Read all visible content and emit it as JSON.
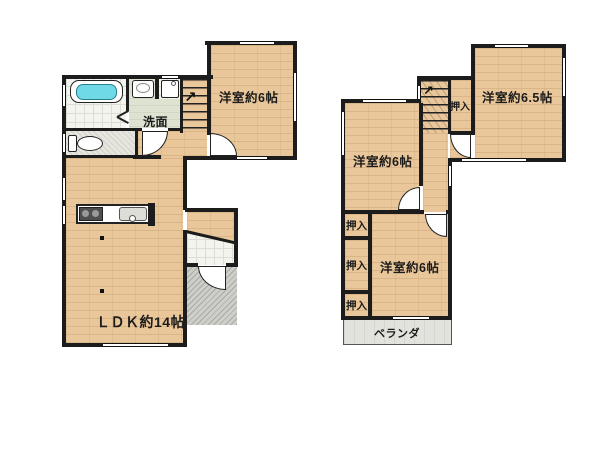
{
  "floorplan": {
    "floor1": {
      "rooms": {
        "living": "ＬＤＫ約14帖",
        "western_room": "洋室約6帖",
        "washroom": "洗面"
      },
      "fixtures": [
        "bathtub",
        "wash-basin",
        "washing-machine",
        "toilet",
        "kitchen-stove",
        "kitchen-sink",
        "staircase",
        "entrance-porch"
      ]
    },
    "floor2": {
      "rooms": {
        "western_room_65": "洋室約6.5帖",
        "western_room_left": "洋室約6帖",
        "western_room_bottom": "洋室約6帖",
        "closet_by_stairs": "押入",
        "closet_top": "押入",
        "closet_middle": "押入",
        "closet_bottom": "押入",
        "veranda": "ベランダ"
      },
      "fixtures": [
        "staircase"
      ]
    },
    "stair_arrow": "↗",
    "colors": {
      "background": "#ffffff",
      "wall": "#1c1c1c",
      "wood_floor": "#e9c79a",
      "washroom_floor": "#dde3d0",
      "tub_water": "#6fd9e8",
      "porch_gray": "#cfcfca",
      "veranda_gray": "#e3e3de"
    }
  }
}
